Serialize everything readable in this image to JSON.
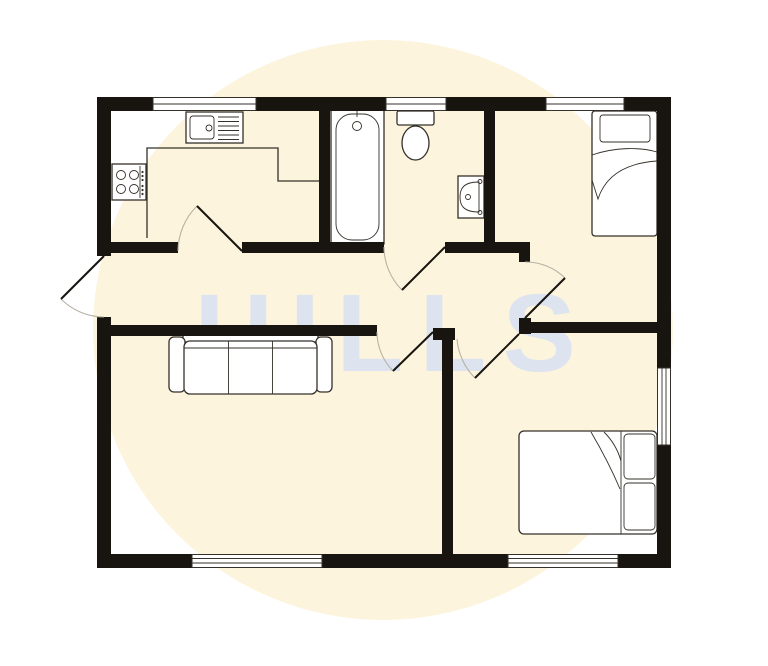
{
  "watermark": {
    "text": "HILLS"
  },
  "colors": {
    "background": "#ffffff",
    "circle": "#fcf4dd",
    "watermark": "#dde4f0",
    "wall": "#181510",
    "line": "#35302a",
    "arc": "#b9b2a4",
    "fixture": "#ffffff"
  },
  "floorplan": {
    "type": "2d-floor-plan",
    "counts": {
      "windows": 6,
      "door_swings": 6,
      "rooms": 6
    },
    "fixtures": [
      "kitchen-sink-with-drainer",
      "four-ring-hob",
      "kitchen-counter",
      "bathtub",
      "toilet",
      "wash-basin",
      "single-bed",
      "three-seat-sofa",
      "double-bed"
    ]
  }
}
